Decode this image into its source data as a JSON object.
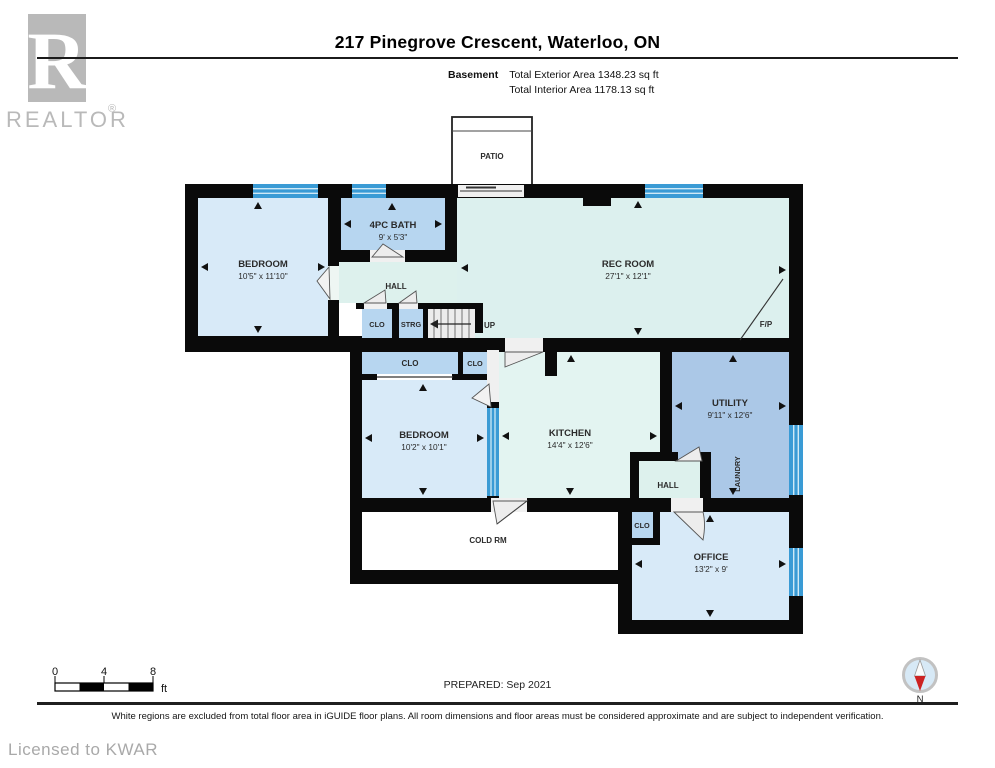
{
  "brand": {
    "logo_letter": "R",
    "wordmark": "REALTOR",
    "registered": "®",
    "licensed": "Licensed to KWAR"
  },
  "header": {
    "title": "217 Pinegrove Crescent, Waterloo, ON",
    "floor_label": "Basement",
    "total_exterior": "Total Exterior Area 1348.23 sq ft",
    "total_interior": "Total Interior Area 1178.13 sq ft"
  },
  "rooms": {
    "patio": "PATIO",
    "bedroom1": {
      "name": "BEDROOM",
      "dims": "10'5\" x 11'10\""
    },
    "bath": {
      "name": "4PC BATH",
      "dims": "9' x 5'3\""
    },
    "hall1": "HALL",
    "rec": {
      "name": "REC ROOM",
      "dims": "27'1\" x 12'1\""
    },
    "clo1": "CLO",
    "strg": "STRG",
    "up": "UP",
    "clo2": "CLO",
    "clo3": "CLO",
    "bedroom2": {
      "name": "BEDROOM",
      "dims": "10'2\" x 10'1\""
    },
    "kitchen": {
      "name": "KITCHEN",
      "dims": "14'4\" x 12'6\""
    },
    "utility": {
      "name": "UTILITY",
      "dims": "9'11\" x 12'6\""
    },
    "laundry": "LAUNDRY",
    "hall2": "HALL",
    "clo4": "CLO",
    "coldrm": "COLD RM",
    "office": {
      "name": "OFFICE",
      "dims": "13'2\" x 9'"
    },
    "fp": "F/P"
  },
  "footer": {
    "scale_0": "0",
    "scale_4": "4",
    "scale_8": "8",
    "scale_unit": "ft",
    "prepared": "PREPARED: Sep 2021",
    "north": "N",
    "disclaimer": "White regions are excluded from total floor area in iGUIDE floor plans. All room dimensions and floor areas must be considered approximate and are subject to independent verification."
  },
  "colors": {
    "room_light_blue": "#d8eaf8",
    "room_medium_blue": "#b7d6f0",
    "room_utility_blue": "#abc8e7",
    "room_teal": "#dcf0ee",
    "window_blue": "#3a9bd5",
    "wall_black": "#0a0a0a",
    "compass_red": "#cc2222",
    "brand_gray": "#b9b9b9"
  }
}
